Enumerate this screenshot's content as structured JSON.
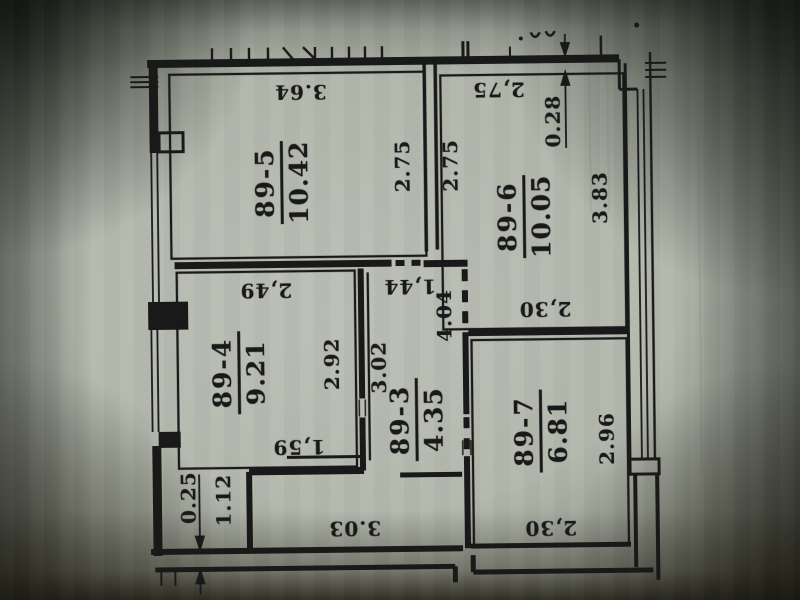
{
  "document": {
    "kind": "apartment floor plan (photographed technical drawing)",
    "unit_prefix": "89"
  },
  "colors": {
    "paper": "#afb4a8",
    "ink": "#191919",
    "shadow_corner": "#31352e"
  },
  "rooms": [
    {
      "number": "89-5",
      "area": "10.42"
    },
    {
      "number": "89-6",
      "area": "10.05"
    },
    {
      "number": "89-4",
      "area": "9.21"
    },
    {
      "number": "89-3",
      "area": "4.35"
    },
    {
      "number": "89-7",
      "area": "6.81"
    }
  ],
  "dimensions": [
    {
      "value": "3.64"
    },
    {
      "value": "2.75"
    },
    {
      "value": "2.75"
    },
    {
      "value": "2,75"
    },
    {
      "value": "0.28"
    },
    {
      "value": "3.83"
    },
    {
      "value": "2,49"
    },
    {
      "value": "2.92"
    },
    {
      "value": "3.02"
    },
    {
      "value": "1,44"
    },
    {
      "value": "4.04"
    },
    {
      "value": "2,30"
    },
    {
      "value": "2.96"
    },
    {
      "value": "1,59"
    },
    {
      "value": "0.25"
    },
    {
      "value": "1.12"
    },
    {
      "value": "3.03"
    },
    {
      "value": "2,30"
    }
  ]
}
